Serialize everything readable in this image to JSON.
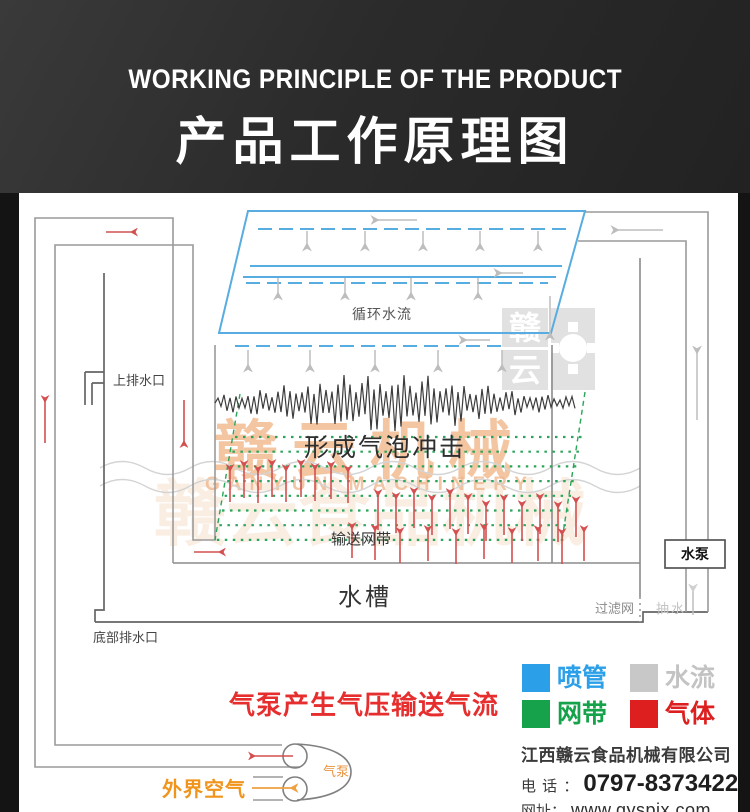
{
  "header": {
    "title_en": "WORKING PRINCIPLE OF THE PRODUCT",
    "title_zh": "产品工作原理图"
  },
  "diagram": {
    "labels": {
      "circulating_water": "循环水流",
      "upper_drain": "上排水口",
      "bubble_impact": "形成气泡冲击",
      "conveyor_belt": "输送网带",
      "water_tank": "水槽",
      "filter_mesh": "过滤网",
      "pump_water": "抽水",
      "water_pump": "水泵",
      "bottom_drain": "底部排水口",
      "air_caption": "气泵产生气压输送气流",
      "outside_air": "外界空气",
      "air_pump": "气泵"
    },
    "colors": {
      "pipe_blue": "#57ade0",
      "mesh_green": "#2ba55a",
      "gas_red": "#d45050",
      "water_gray": "#bdbdbd",
      "caption_red": "#e62e2e",
      "air_orange": "#f0941c"
    },
    "watermark": {
      "main": "赣云机械",
      "sub": "GANYUN MACHINERY",
      "ghost": "赣云食品机械",
      "seal_char_top": "赣",
      "seal_char_bottom": "云"
    }
  },
  "legend": {
    "items": [
      {
        "label": "喷管",
        "color": "#2b9fe8",
        "style": "background:#2b9fe8"
      },
      {
        "label": "水流",
        "color": "#c8c8c8",
        "style": "background:#c8c8c8"
      },
      {
        "label": "网带",
        "color": "#16a24b",
        "style": "background:#16a24b"
      },
      {
        "label": "气体",
        "color": "#dd1f1f",
        "style": "background:#dd1f1f"
      }
    ]
  },
  "company": {
    "name": "江西赣云食品机械有限公司",
    "phone_label": "电 话 ：",
    "phone": "0797-8373422",
    "web_label": "网址：",
    "website": "www.gyspjx.com"
  }
}
